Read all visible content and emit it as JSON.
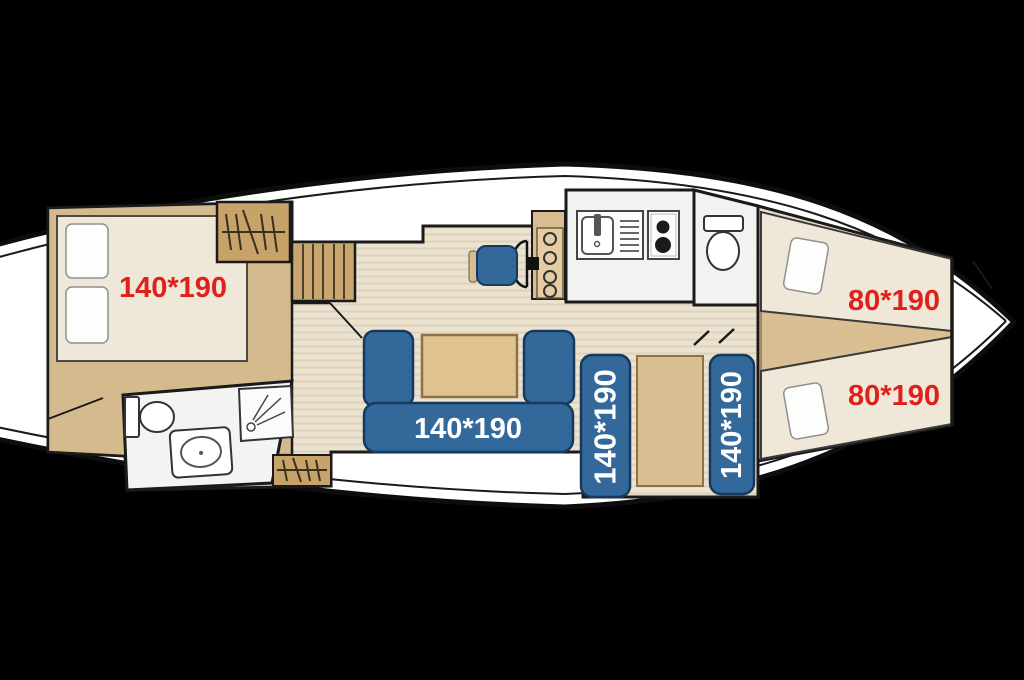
{
  "scene": {
    "type": "boat-floor-plan",
    "background": "#000000",
    "hull_fill": "#ffffff",
    "outline_color": "#111111"
  },
  "palette": {
    "floor_cream": "#ebe2cf",
    "floor_tan": "#d5ba8e",
    "wood_dark": "#c9a76f",
    "mattress_cream": "#efe8d8",
    "upholstery_blue": "#33689b",
    "upholstery_border": "#16395e",
    "fixture_gray": "#f2f2f1",
    "label_red": "#e0201b",
    "label_white": "#ffffff"
  },
  "labels": {
    "aft_double_bed": "140*190",
    "salon_sofa_bed": "140*190",
    "mid_cabin_berth_left": "140*190",
    "mid_cabin_berth_right": "140*190",
    "bow_berth_upper": "80*190",
    "bow_berth_lower": "80*190"
  }
}
